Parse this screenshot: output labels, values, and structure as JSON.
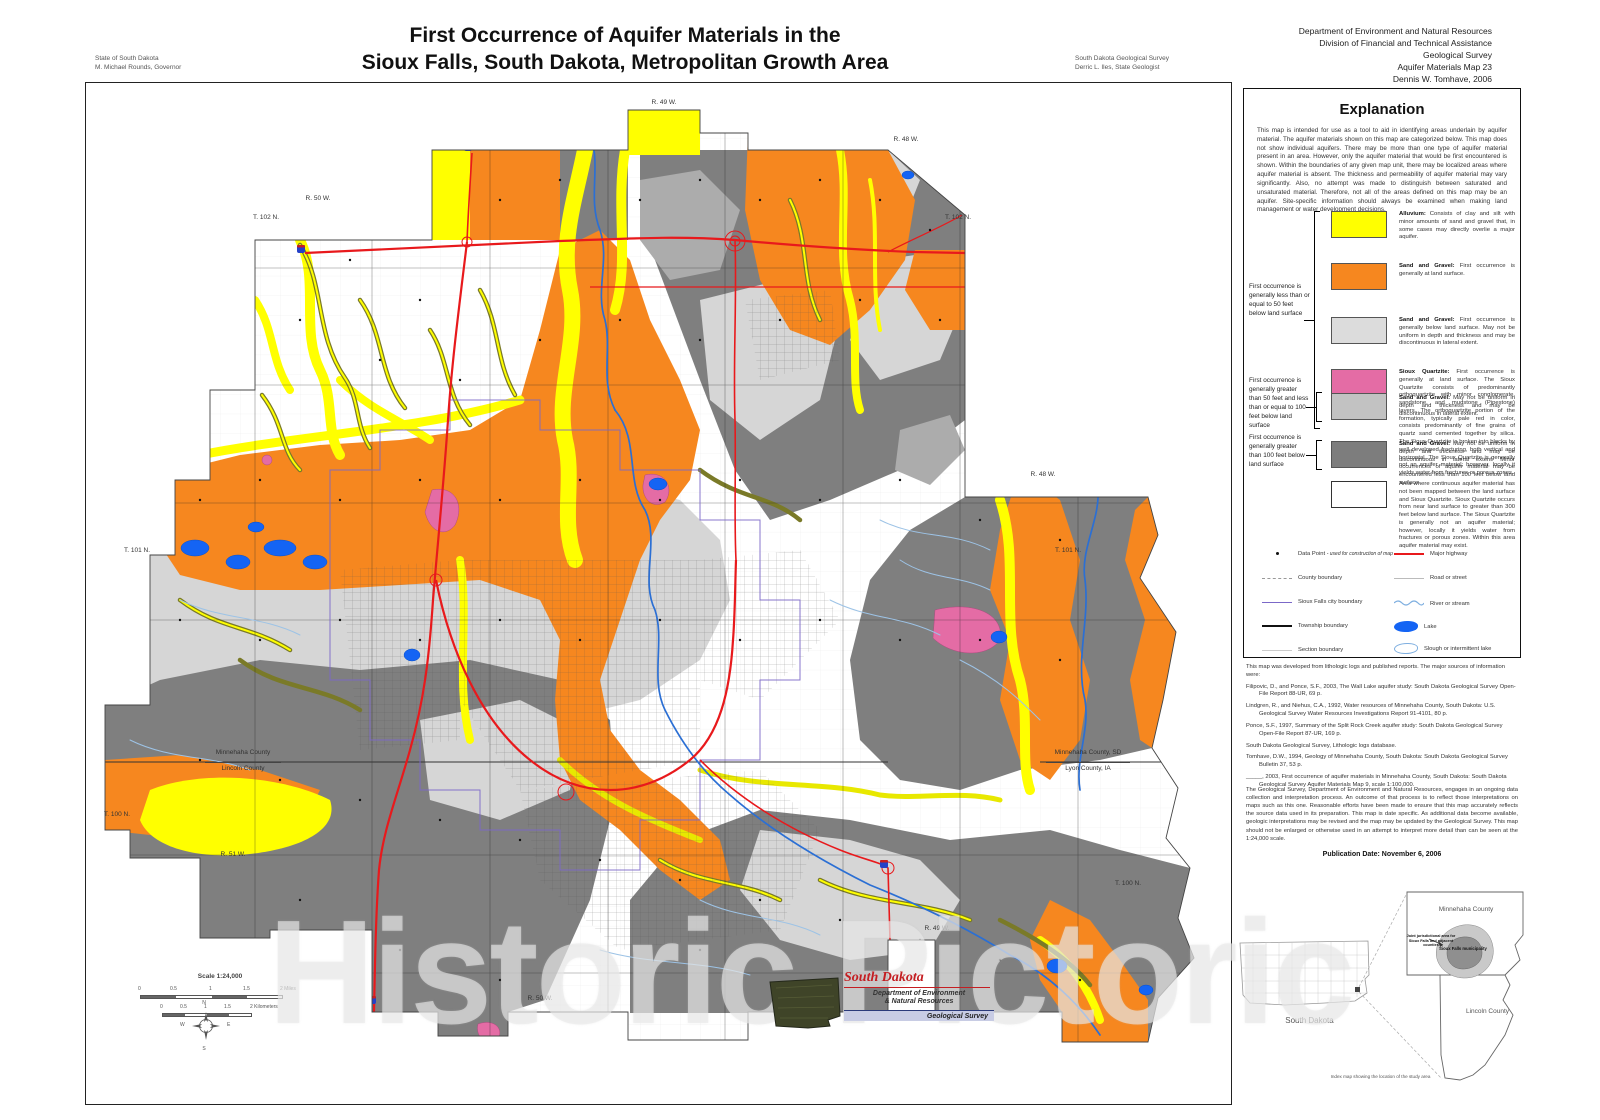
{
  "page": {
    "state_line1": "State of South Dakota",
    "state_line2": "M. Michael Rounds, Governor",
    "title_line1": "First Occurrence of Aquifer Materials in the",
    "title_line2": "Sioux Falls, South Dakota, Metropolitan Growth Area",
    "survey_line1": "South Dakota Geological Survey",
    "survey_line2": "Derric L. Iles, State Geologist",
    "agency_line1": "Department of Environment and Natural Resources",
    "agency_line2": "Division of Financial and Technical Assistance",
    "agency_line3": "Geological Survey",
    "agency_line4": "Aquifer Materials Map 23",
    "agency_line5": "Dennis W. Tomhave, 2006",
    "watermark": "Historic Pictoric"
  },
  "map": {
    "edge_labels": {
      "r49w_top": "R. 49 W.",
      "r48w_ne": "R. 48 W.",
      "r50w_nw": "R. 50 W.",
      "t102n_w": "T. 102 N.",
      "t102n_e": "T. 102 N.",
      "t101n_w": "T. 101 N.",
      "r48w_e": "R. 48 W.",
      "t101n_e": "T. 101 N.",
      "t100n_w": "T. 100 N.",
      "r51w_s": "R. 51 W.",
      "r50w_s": "R. 50 W.",
      "r49w_s": "R. 49 W.",
      "t100n_e": "T. 100 N."
    },
    "county_labels": {
      "left_top": "Minnehaha County",
      "left_bottom": "Lincoln County",
      "right_top": "Minnehaha County, SD",
      "right_bottom": "Lyon County, IA"
    },
    "scale": {
      "title": "Scale 1:24,000",
      "miles_ticks": [
        "0",
        "0.5",
        "1",
        "1.5",
        "2 Miles"
      ],
      "km_ticks": [
        "0",
        "0.5",
        "1",
        "1.5",
        "2 Kilometers"
      ]
    },
    "compass": {
      "n": "N",
      "s": "S",
      "e": "E",
      "w": "W"
    },
    "logo": {
      "script": "South Dakota",
      "line1": "Department of Environment",
      "line2": "& Natural Resources",
      "line3": "Geological Survey"
    },
    "colors": {
      "alluvium": "#FFFF00",
      "sand_gravel_surface": "#F6871F",
      "sand_gravel_below": "#DCDCDC",
      "sioux_quartzite": "#E46CA5",
      "sand_gravel_50_100": "#C2C2C2",
      "sand_gravel_100": "#7D7D7D",
      "major_highway": "#E8191C",
      "lake": "#1464F4",
      "city_boundary": "#7B68C8"
    }
  },
  "explanation": {
    "title": "Explanation",
    "intro": "This map is intended for use as a tool to aid in identifying areas underlain by aquifer material. The aquifer materials shown on this map are categorized below. This map does not show individual aquifers. There may be more than one type of aquifer material present in an area. However, only the aquifer material that would be first encountered is shown. Within the boundaries of any given map unit, there may be localized areas where aquifer material is absent. The thickness and permeability of aquifer material may vary significantly. Also, no attempt was made to distinguish between saturated and unsaturated material. Therefore, not all of the areas defined on this map may be an aquifer. Site-specific information should always be examined when making land management or water development decisions.",
    "group1_label": "First occurrence is generally less than or equal to 50 feet below land surface",
    "group2_label": "First occurrence is generally greater than 50 feet and less than or equal to 100 feet below land surface",
    "group3_label": "First occurrence is generally greater than 100 feet below land surface",
    "alluvium": {
      "name": "Alluvium:",
      "desc": "Consists of clay and silt with minor amounts of sand and gravel that, in some cases may directly overlie a major aquifer."
    },
    "sg_surface": {
      "name": "Sand and Gravel:",
      "desc": "First occurrence is generally at land surface."
    },
    "sg_below": {
      "name": "Sand and Gravel:",
      "desc": "First occurrence is generally below land surface. May not be uniform in depth and thickness and may be discontinuous in lateral extent."
    },
    "quartzite": {
      "name": "Sioux Quartzite:",
      "desc": "First occurrence is generally at land surface. The Sioux Quartzite consists of predominantly orthoquartzite with minor conglomerate, sandstone, and mudstone (Pipestone) layers. The orthoquartzite portion of the formation, typically pale red in color, consists predominantly of fine grains of quartz sand cemented together by silica. The Sioux Quartzite is broken into blocks by well developed fracturing, both vertical and horizontal. The Sioux Quartzite is generally not an aquifer material; however, locally it yields water from fractures or porous zones."
    },
    "sg_50_100": {
      "name": "Sand and Gravel:",
      "desc": "May not be uniform in depth and thickness and may be discontinuous in lateral extent."
    },
    "sg_100": {
      "name": "Sand and Gravel:",
      "desc": "May not be uniform in depth and thickness and may be discontinuous in lateral extent. Minor occurrences of aquifer material may be encountered less than 100 feet below land surface."
    },
    "unmapped_desc": "Area where continuous aquifer material has not been mapped between the land surface and Sioux Quartzite. Sioux Quartzite occurs from near land surface to greater than 300 feet below land surface. The Sioux Quartzite is generally not an aquifer material; however, locally it yields water from fractures or porous zones. Within this area aquifer material may exist.",
    "symbols": {
      "data_point": "Data Point",
      "data_point_note": "- used for construction of map",
      "county": "County boundary",
      "city": "Sioux Falls city boundary",
      "township": "Township boundary",
      "section": "Section boundary",
      "highway": "Major highway",
      "road": "Road or street",
      "river": "River or stream",
      "lake": "Lake",
      "slough": "Slough or intermittent lake"
    },
    "sources_intro": "This map was developed from lithologic logs and published reports. The major sources of information were:",
    "refs": [
      "Filipovic, D., and Ponce, S.F., 2003, The Wall Lake aquifer study: South Dakota Geological Survey Open-File Report 88-UR, 69 p.",
      "Lindgren, R., and Niehus, C.A., 1992, Water resources of Minnehaha County, South Dakota: U.S. Geological Survey Water Resources Investigations Report 91-4101, 80 p.",
      "Ponce, S.F., 1997, Summary of the Split Rock Creek aquifer study: South Dakota Geological Survey Open-File Report 87-UR, 169 p.",
      "South Dakota Geological Survey, Lithologic logs database.",
      "Tomhave, D.W., 1994, Geology of Minnehaha County, South Dakota: South Dakota Geological Survey Bulletin 37, 53 p.",
      "_____, 2003, First occurrence of aquifer materials in Minnehaha County, South Dakota: South Dakota Geological Survey Aquifer Materials Map 9, scale 1:100,000."
    ],
    "disclaimer": "The Geological Survey, Department of Environment and Natural Resources, engages in an ongoing data collection and interpretation process. An outcome of that process is to reflect those interpretations on maps such as this one. Reasonable efforts have been made to ensure that this map accurately reflects the source data used in its preparation. This map is date specific. As additional data become available, geologic interpretations may be revised and the map may be updated by the Geological Survey. This map should not be enlarged or otherwise used in an attempt to interpret more detail than can be seen at the 1:24,000 scale.",
    "pub_date": "Publication Date:  November 6, 2006"
  },
  "index_map": {
    "state_label": "South Dakota",
    "minnehaha": "Minnehaha County",
    "lincoln": "Lincoln County",
    "municipality": "Sioux Falls municipality",
    "joint_note": "Joint jurisdictional area for Sioux Falls and adjacent counties",
    "caption": "Index map showing the location of the study area"
  }
}
